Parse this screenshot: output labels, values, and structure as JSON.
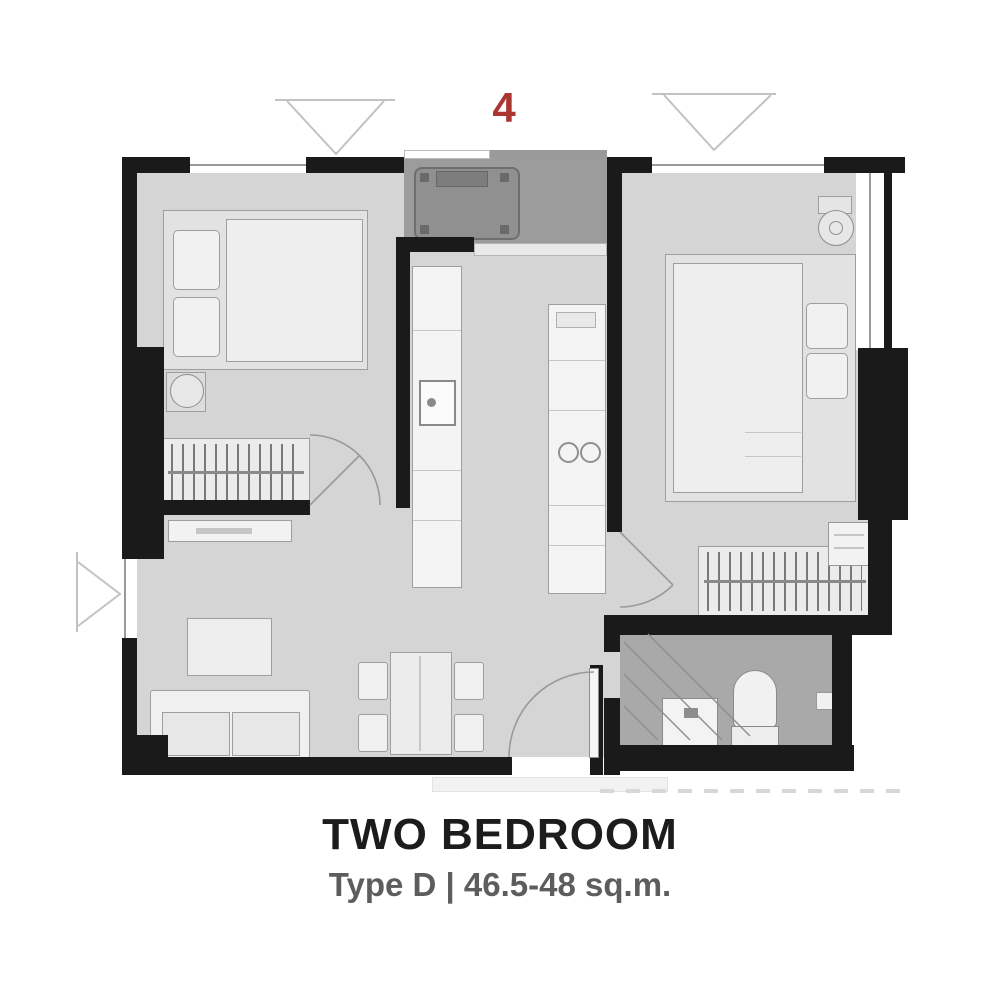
{
  "plan": {
    "unit_number": "4",
    "colors": {
      "accent_red": "#ab3530",
      "wall": "#1a1a1a",
      "floor": "#d5d5d5",
      "bathroom_floor": "#a9a9a9",
      "laundry_floor": "#9c9c9c",
      "furniture": "#ededed"
    }
  },
  "caption": {
    "title": "TWO BEDROOM",
    "subtitle": "Type D | 46.5-48 sq.m."
  }
}
